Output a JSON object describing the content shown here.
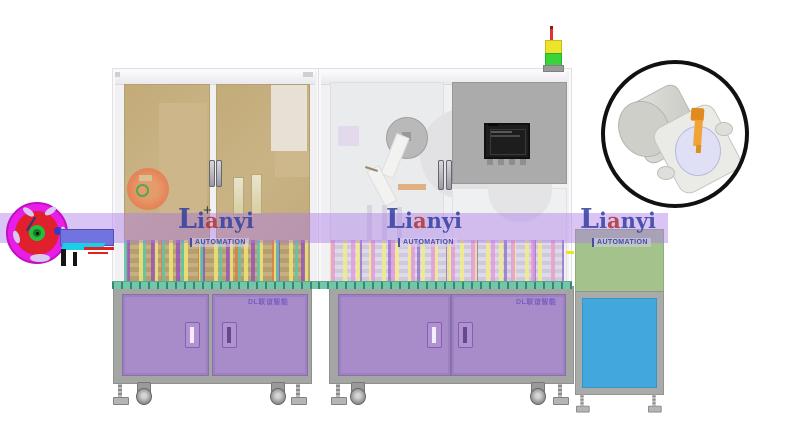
{
  "watermark": {
    "initial": "L",
    "rest1": "i",
    "accent": "a",
    "rest2": "nyi",
    "subtitle": "AUTOMATION"
  },
  "cabinets": {
    "left_label": "DL联谊智能",
    "right_label": "DL联谊智能"
  },
  "crosshair_glyph": "+",
  "colors": {
    "band": "rgba(173,124,232,0.45)",
    "navy": "#3340a0",
    "wm_red": "#b23430",
    "door_purple": "#a88cc9",
    "glass_tan": "#c5ae7d",
    "panel_gray": "#ababab",
    "green_panel": "#a4c28c",
    "blue_panel": "#42a7dd",
    "reel_magenta": "#e81ee8",
    "reel_red": "#e0202c",
    "hub_green": "#22c03c",
    "feeder_blue": "#7173de",
    "cyan": "#19cfe8",
    "tower_red": "#e03030",
    "tower_yellow": "#ece32a",
    "tower_green": "#3ad43a",
    "pin_orange": "#f0a435"
  }
}
